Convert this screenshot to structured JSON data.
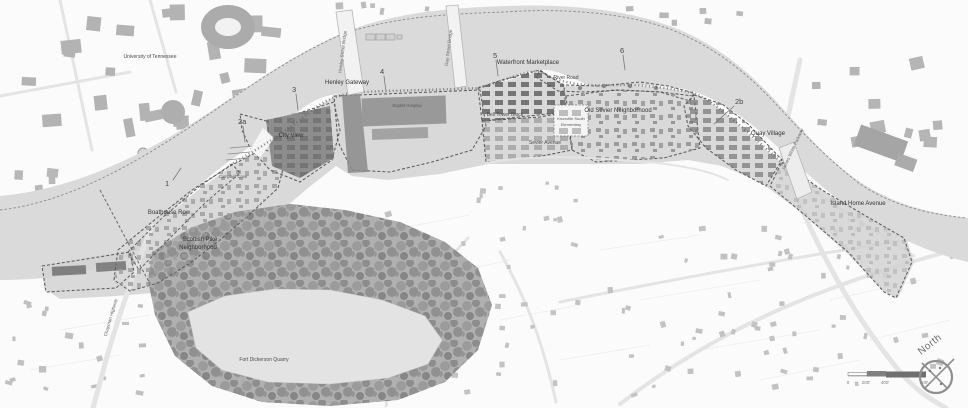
{
  "labels": {
    "university": "University of Tennessee",
    "boathouse_row": "Boathouse Row",
    "scottish_pike_1": "Scottish Pike",
    "scottish_pike_2": "Neighborhood",
    "city_view": "City View",
    "cove": "Campbell Cove",
    "henley_gateway": "Henley Gateway",
    "baptist_hospital": "Baptist Hospital",
    "waterfront_marketplace": "Waterfront Marketplace",
    "river_road": "River Road",
    "bell_tower_block": "Bell Tower Block",
    "old_sevier": "Old Sevier Neighborhood",
    "school_1": "Knoxville South",
    "school_2": "Elementary",
    "sevier_avenue": "Sevier Avenue",
    "quay_village": "Quay Village",
    "island_home_avenue": "Island Home Avenue",
    "fort_dickerson_quarry": "Fort Dickerson Quarry",
    "henley_street_bridge": "Henley Street Bridge",
    "gay_street_bridge": "Gay Street Bridge",
    "james_white_parkway": "James White Parkway",
    "chapman_highway": "Chapman Highway",
    "north": "North"
  },
  "markers": [
    {
      "label": "1"
    },
    {
      "label": "2a"
    },
    {
      "label": "3"
    },
    {
      "label": "4"
    },
    {
      "label": "5"
    },
    {
      "label": "6"
    },
    {
      "label": "2b"
    }
  ],
  "scale_bar": {
    "ticks": [
      "0",
      "200'",
      "400'",
      "800'"
    ]
  },
  "colors": {
    "river": "#dadada",
    "study_area": "#cfcfcf",
    "district_dark": "#8f8f8f",
    "building": "#b3b3b3",
    "forest": "#8a8a8a",
    "boundary": "#5a5a5a"
  }
}
